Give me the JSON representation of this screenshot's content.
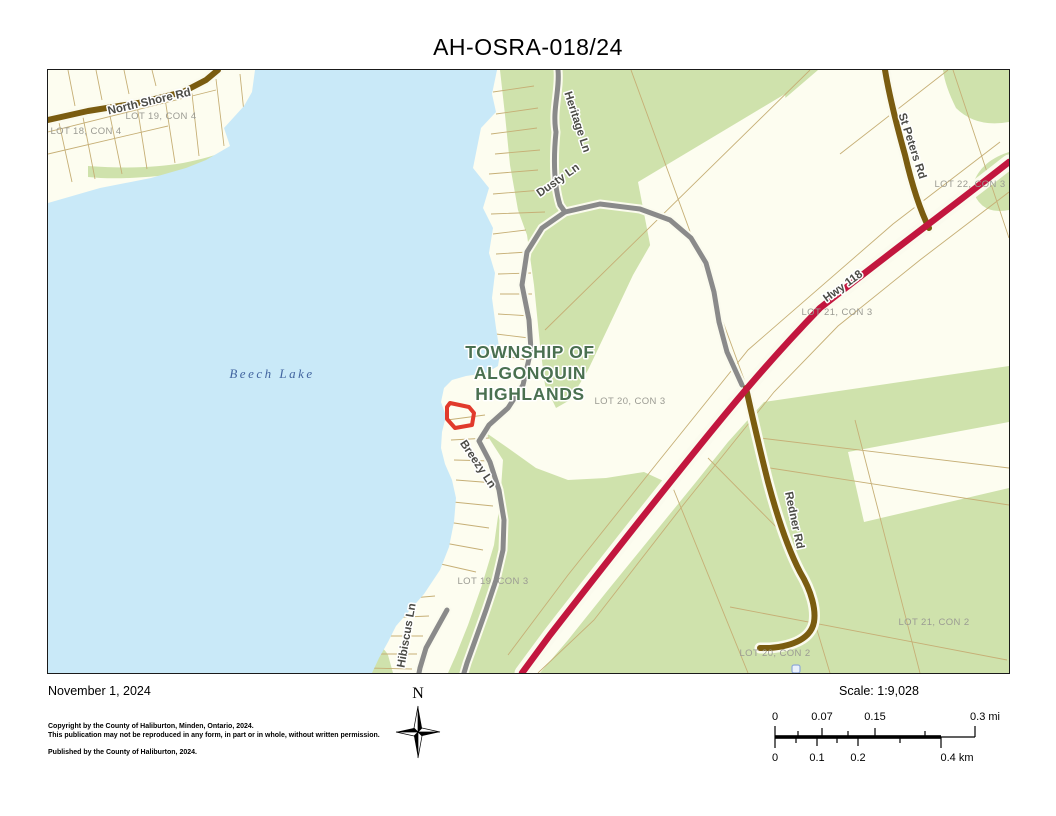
{
  "title": "AH-OSRA-018/24",
  "map": {
    "township_lines": [
      "TOWNSHIP OF",
      "ALGONQUIN",
      "HIGHLANDS"
    ],
    "lake_label": "Beech Lake",
    "lot_labels": [
      {
        "text": "LOT 19, CON 4"
      },
      {
        "text": "LOT 18, CON 4"
      },
      {
        "text": "LOT 22, CON 3"
      },
      {
        "text": "LOT 21, CON 3"
      },
      {
        "text": "LOT 20, CON 3"
      },
      {
        "text": "LOT 19, CON 3"
      },
      {
        "text": "LOT 21, CON 2"
      },
      {
        "text": "LOT 20, CON 2"
      }
    ],
    "road_labels": [
      {
        "text": "North Shore Rd"
      },
      {
        "text": "Heritage Ln"
      },
      {
        "text": "Dusty Ln"
      },
      {
        "text": "St Peters Rd"
      },
      {
        "text": "Hwy 118"
      },
      {
        "text": "Redner Rd"
      },
      {
        "text": "Breezy Ln"
      },
      {
        "text": "Hibiscus Ln"
      }
    ],
    "colors": {
      "water": "#C9E9F8",
      "land": "#FDFDF0",
      "vegetation": "#CFE2AC",
      "highway": "#C2163E",
      "road_brown": "#7A5C10",
      "road_gray": "#8A8A8A",
      "parcel_line": "#C6AF76",
      "highlight_parcel": "#E13A2C",
      "township_text": "#4A7050",
      "lake_text": "#41649F"
    }
  },
  "footer": {
    "date": "November 1, 2024",
    "copyright_line1": "Copyright by the County of Haliburton, Minden, Ontario, 2024.",
    "copyright_line2": "This publication may not be reproduced in any form, in part or in whole, without written permission.",
    "published_line": "Published by the County of Haliburton, 2024.",
    "north_label": "N"
  },
  "scale": {
    "label": "Scale: 1:9,028",
    "mi_ticks": [
      "0",
      "0.07",
      "0.15",
      "0.3 mi"
    ],
    "km_ticks": [
      "0",
      "0.1",
      "0.2",
      "0.4 km"
    ]
  }
}
